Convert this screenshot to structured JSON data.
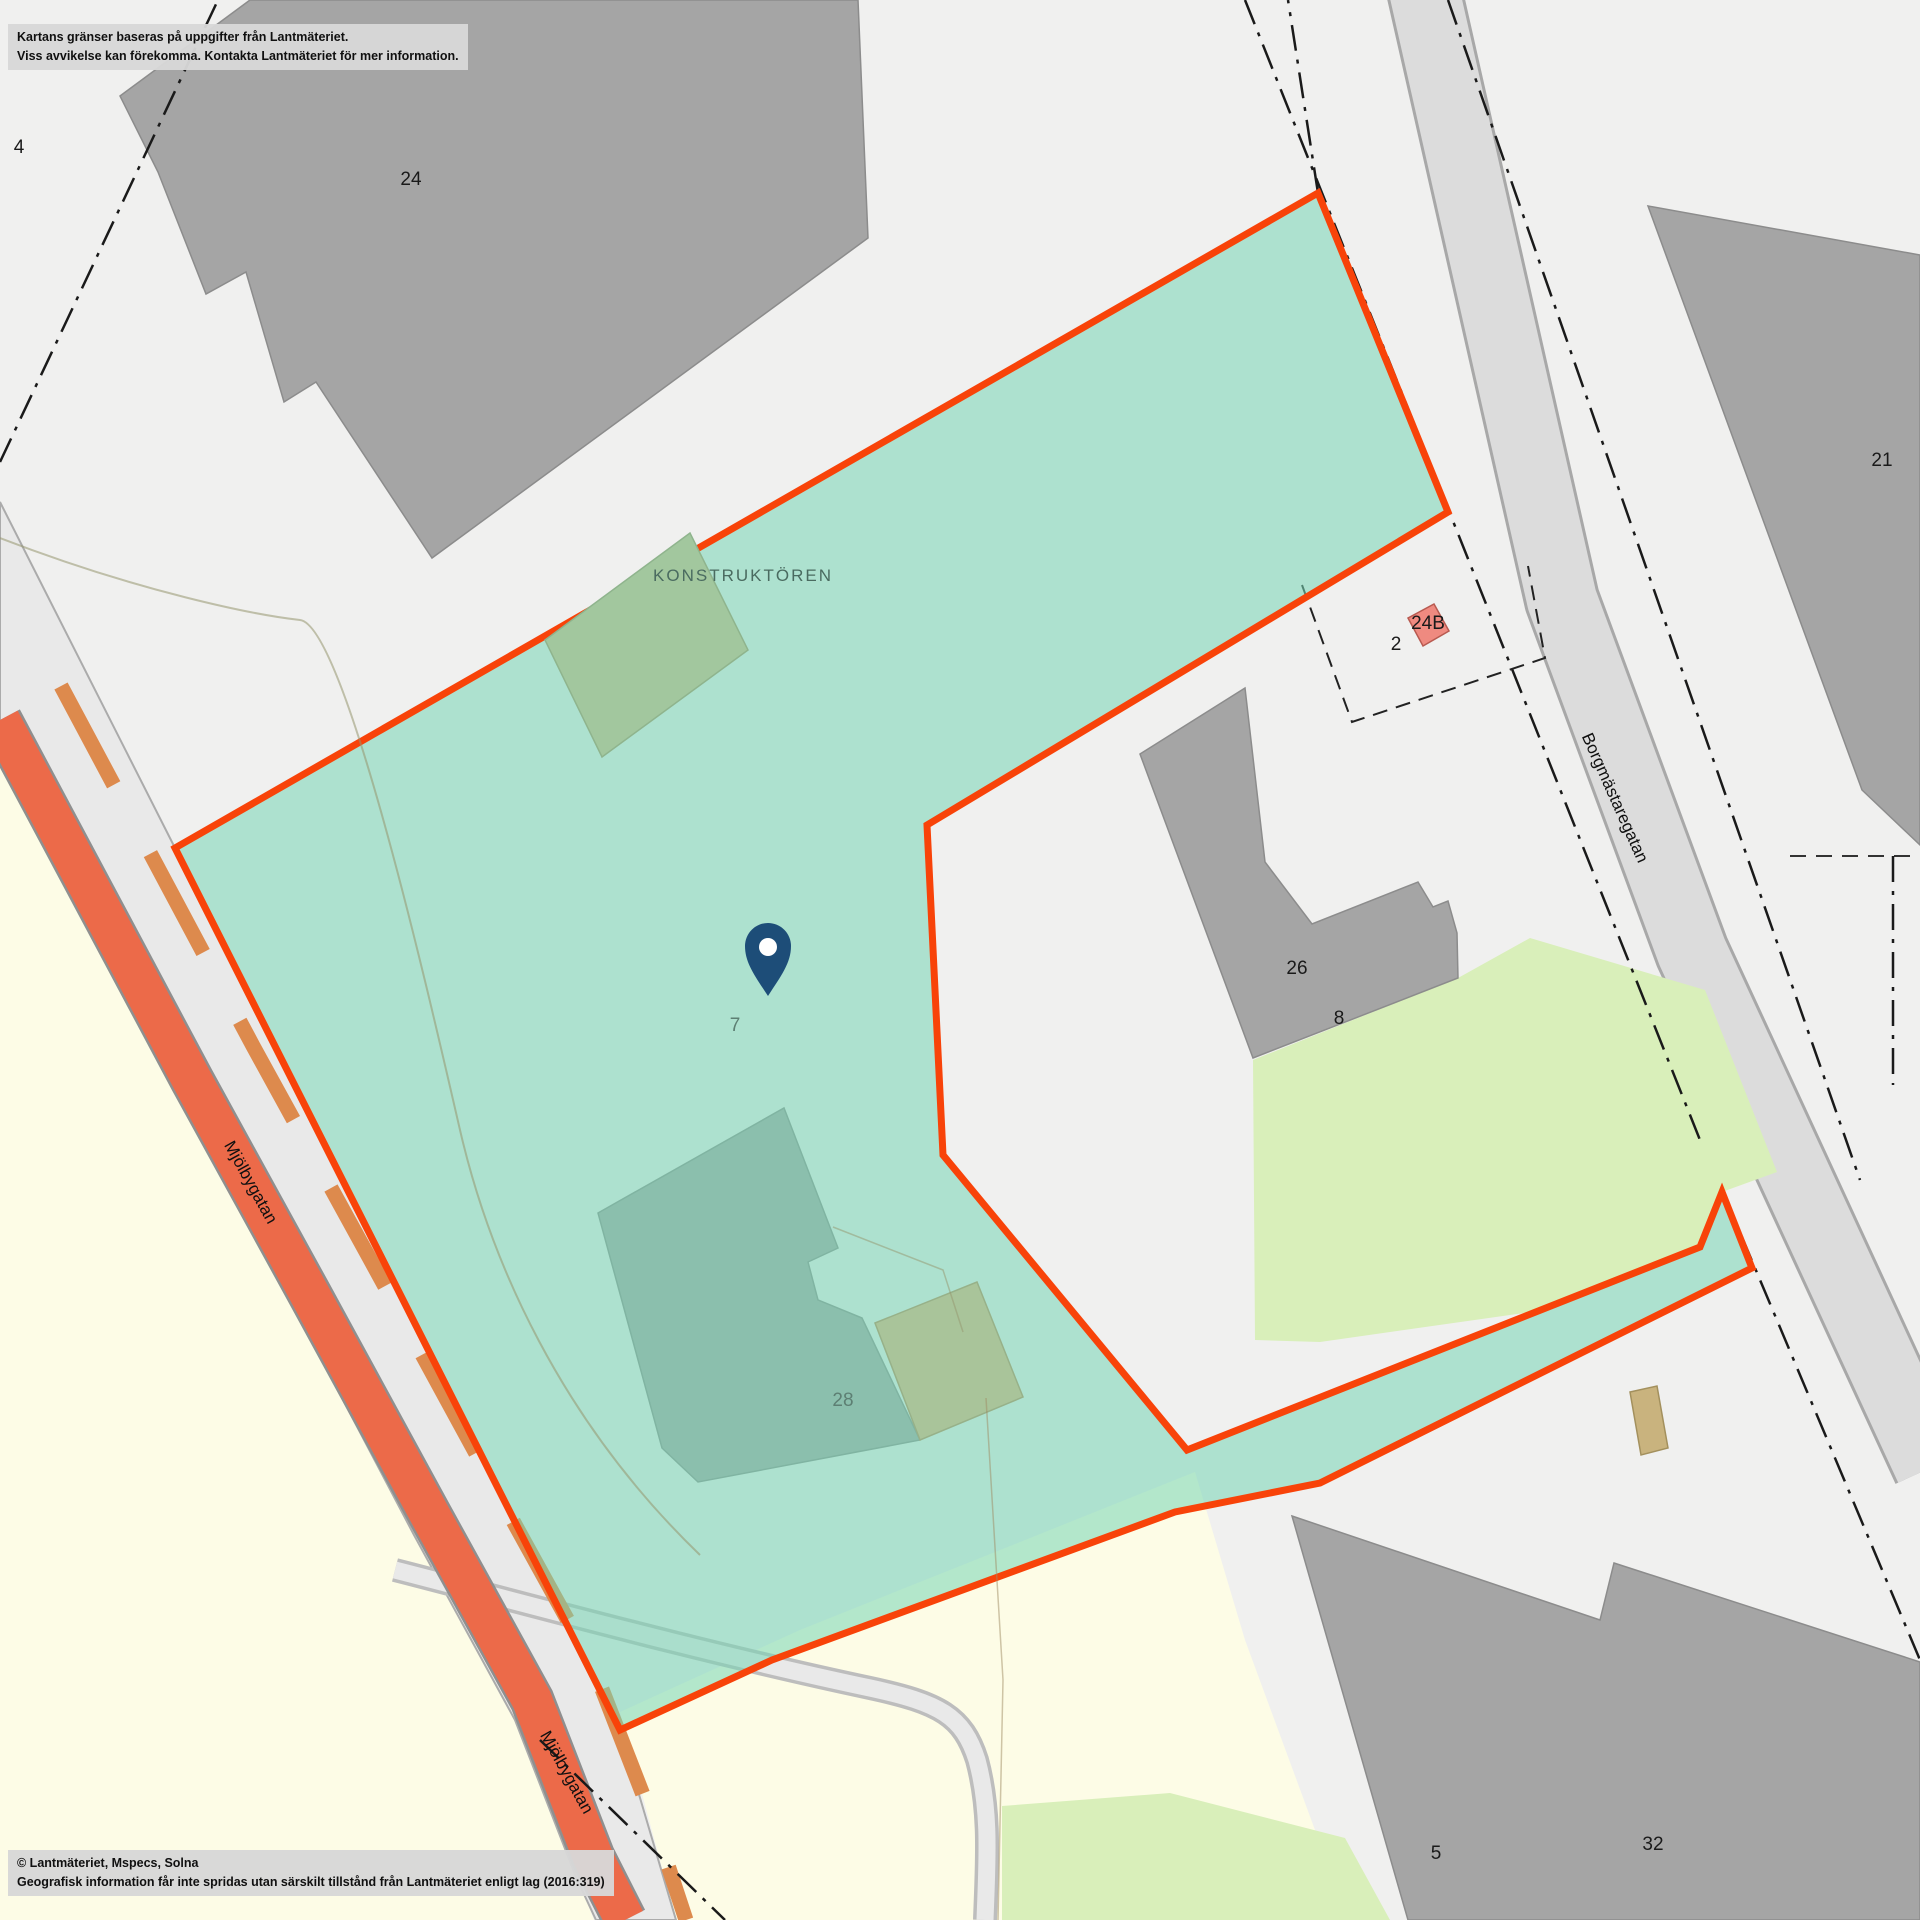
{
  "attribution": {
    "line1": "Kartans gränser baseras på uppgifter från Lantmäteriet.",
    "line2": "Viss avvikelse kan förekomma. Kontakta Lantmäteriet för mer information."
  },
  "copyright": {
    "line1": "© Lantmäteriet, Mspecs, Solna",
    "line2": "Geografisk information får inte spridas utan särskilt tillstånd från Lantmäteriet enligt lag (2016:319)"
  },
  "property": {
    "name": "KONSTRUKTÖREN",
    "plot_number": "7"
  },
  "streets": {
    "mjolbygatan": "Mjölbygatan",
    "borgmastaregatan": "Borgmästaregatan"
  },
  "labels": {
    "plot_4": "4",
    "building_24": "24",
    "building_21": "21",
    "plot_2": "2",
    "building_24b": "24B",
    "building_26": "26",
    "plot_8": "8",
    "building_28": "28",
    "plot_5": "5",
    "building_32": "32"
  },
  "marker": {
    "type": "map-pin"
  },
  "colors": {
    "background": "#f0f0ef",
    "property_fill": "rgba(118,214,180,0.55)",
    "property_border": "#f84309",
    "road_stripe": "#ec6a49",
    "road_center_dash": "#dd8a4d",
    "road_surface": "#e9e9e9",
    "building_gray": "#a5a5a5",
    "building_red": "#ef8a80",
    "building_tan": "#c9b37e",
    "vegetation": "#d9efba",
    "land_yellow": "#fdfce6",
    "pin": "#1d4d78",
    "boundary_line": "#1a1a1a"
  }
}
